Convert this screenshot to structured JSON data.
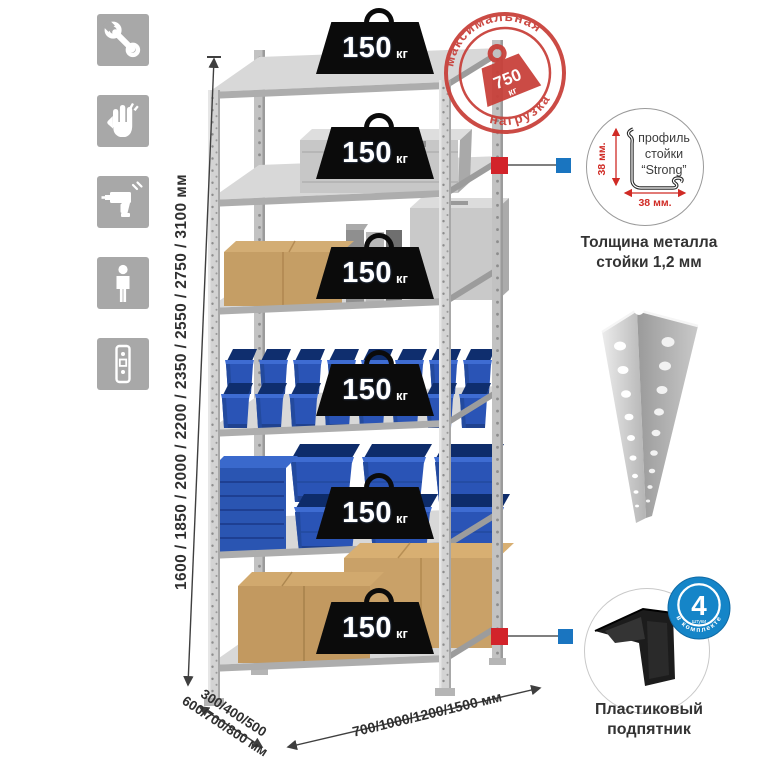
{
  "sidebar": {
    "icons": [
      {
        "name": "wrench-icon"
      },
      {
        "name": "gloves-icon"
      },
      {
        "name": "drill-icon"
      },
      {
        "name": "person-height-icon"
      },
      {
        "name": "rack-post-icon"
      }
    ]
  },
  "stamp": {
    "arc_top": "максимальная",
    "arc_bottom": "нагрузка",
    "value": "750",
    "unit": "кг",
    "color": "#c8403a"
  },
  "rack": {
    "shelf_badges": [
      {
        "value": "150",
        "unit": "кг"
      },
      {
        "value": "150",
        "unit": "кг"
      },
      {
        "value": "150",
        "unit": "кг"
      },
      {
        "value": "150",
        "unit": "кг"
      },
      {
        "value": "150",
        "unit": "кг"
      },
      {
        "value": "150",
        "unit": "кг"
      }
    ]
  },
  "dims": {
    "heights": "1600 / 1850 / 2000 / 2200 / 2350 / 2550 / 2750 / 3100 мм",
    "depth1": "300/400/500",
    "depth2": "600/700/800 мм",
    "width": "700/1000/1200/1500 мм"
  },
  "profile": {
    "word1": "профиль",
    "word2": "стойки",
    "word3": "“Strong”",
    "dim_v": "38 мм.",
    "dim_h": "38 мм.",
    "caption1": "Толщина металла",
    "caption2": "стойки 1,2 мм"
  },
  "foot": {
    "count": "4",
    "count_sub": "штуки",
    "arc": "в комплекте",
    "caption1": "Пластиковый",
    "caption2": "подпятник"
  },
  "colors": {
    "accent_red": "#d2232a",
    "accent_blue": "#1a75c0",
    "bin_blue": "#2a54b6",
    "box_tan": "#c59e65",
    "metal_gray": "#c9c9c9",
    "badge_black": "#0b0b0b",
    "icon_gray": "#a8a8a8"
  }
}
